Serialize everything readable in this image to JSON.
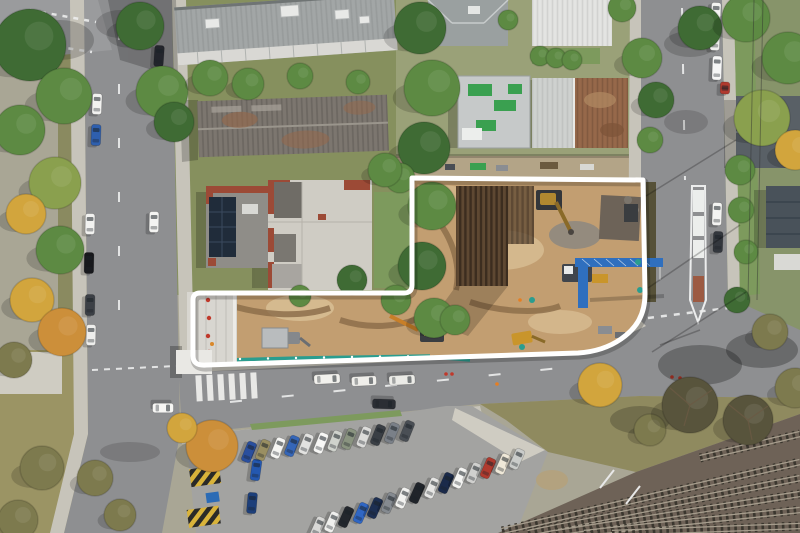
{
  "scene": {
    "type": "aerial-drone-photograph",
    "subject": "corner development site under excavation, outlined with a white property-boundary overlay",
    "no_visible_text": true
  },
  "palette": {
    "base": "#a9a695",
    "road": "#8e8f91",
    "roadLight": "#9a9b9d",
    "sidewalk": "#c7c4ba",
    "concretePad": "#cfccc2",
    "grass": "#76944f",
    "lawn": "#7d9a5d",
    "blockNW": "#86905e",
    "blockNE": "#9aa178",
    "blockE": "#87946a",
    "dirt": "#c29e71",
    "dirtLight": "#d7bc92",
    "dirtDark": "#8f6f4c",
    "piling": "#5e4832",
    "pilingDark": "#3c2d1f",
    "boundary": "#ffffff",
    "barrier": "#2a9d8f",
    "craneBlue": "#2f6fbe",
    "machineYellow": "#c9952b",
    "machineOrange": "#c87f28",
    "roofApartment": "#a2a6a6",
    "roofDark": "#7c766f",
    "rust": "#96684a",
    "roofWhite": "#e3e4e2",
    "roofFlat": "#cfccc4",
    "redTrim": "#9c4a36",
    "solar": "#202c3a",
    "shed": "#b9bcbe",
    "rail": "#6e6257",
    "railTie": "#3a362e",
    "railLine": "#a59c8c",
    "scrub": "#8f8a5f",
    "parking": "#a3a3a1",
    "hatchYellow": "#d9b33a",
    "g1": "#3f6b34",
    "g2": "#5d8a43",
    "g3": "#8aa04e",
    "y": "#d2a53d",
    "o": "#cc8f3a",
    "olv": "#7d7a4e",
    "bare": "#58543c"
  },
  "site_boundary": {
    "stroke_width": 5,
    "path": "M413,178 L643,180 L645,294 C645,314 637,328 621,339 C608,348 594,352 578,353 L206,365 Q193,366 193,356 L193,300 Q193,293 200,293 L404,293 Q412,293 412,285 L412,178 Z"
  },
  "trees": [
    [
      30,
      45,
      36,
      "g1"
    ],
    [
      64,
      96,
      28,
      "g2"
    ],
    [
      20,
      130,
      25,
      "g2"
    ],
    [
      55,
      183,
      26,
      "g3"
    ],
    [
      26,
      214,
      20,
      "y"
    ],
    [
      60,
      250,
      24,
      "g2"
    ],
    [
      32,
      300,
      22,
      "y"
    ],
    [
      62,
      332,
      24,
      "o"
    ],
    [
      14,
      360,
      18,
      "olv"
    ],
    [
      140,
      26,
      24,
      "g1"
    ],
    [
      162,
      92,
      26,
      "g2"
    ],
    [
      174,
      122,
      20,
      "g1"
    ],
    [
      210,
      78,
      18,
      "g2"
    ],
    [
      248,
      84,
      16,
      "g2"
    ],
    [
      300,
      76,
      13,
      "g2"
    ],
    [
      358,
      82,
      12,
      "g2"
    ],
    [
      420,
      28,
      26,
      "g1"
    ],
    [
      432,
      88,
      28,
      "g2"
    ],
    [
      424,
      148,
      26,
      "g1"
    ],
    [
      432,
      206,
      24,
      "g2"
    ],
    [
      422,
      266,
      24,
      "g1"
    ],
    [
      434,
      318,
      20,
      "g2"
    ],
    [
      400,
      178,
      15,
      "g2"
    ],
    [
      385,
      170,
      17,
      "g2"
    ],
    [
      352,
      280,
      15,
      "g1"
    ],
    [
      396,
      300,
      15,
      "g2"
    ],
    [
      300,
      296,
      11,
      "g2"
    ],
    [
      455,
      320,
      15,
      "g2"
    ],
    [
      540,
      56,
      10,
      "g2"
    ],
    [
      556,
      58,
      10,
      "g2"
    ],
    [
      572,
      60,
      10,
      "g2"
    ],
    [
      622,
      8,
      14,
      "g2"
    ],
    [
      642,
      58,
      20,
      "g2"
    ],
    [
      656,
      100,
      18,
      "g1"
    ],
    [
      650,
      140,
      13,
      "g2"
    ],
    [
      700,
      28,
      22,
      "g1"
    ],
    [
      746,
      18,
      24,
      "g2"
    ],
    [
      788,
      58,
      26,
      "g2"
    ],
    [
      762,
      118,
      28,
      "g3"
    ],
    [
      795,
      150,
      20,
      "y"
    ],
    [
      740,
      170,
      15,
      "g2"
    ],
    [
      741,
      210,
      13,
      "g2"
    ],
    [
      746,
      252,
      12,
      "g2"
    ],
    [
      737,
      300,
      13,
      "g1"
    ],
    [
      600,
      385,
      22,
      "y"
    ],
    [
      650,
      430,
      16,
      "olv"
    ],
    [
      770,
      332,
      18,
      "olv"
    ],
    [
      690,
      405,
      28,
      "bare"
    ],
    [
      748,
      420,
      25,
      "bare"
    ],
    [
      795,
      388,
      20,
      "olv"
    ],
    [
      212,
      446,
      26,
      "o"
    ],
    [
      182,
      428,
      15,
      "y"
    ],
    [
      95,
      478,
      18,
      "olv"
    ],
    [
      42,
      468,
      22,
      "olv"
    ],
    [
      18,
      520,
      20,
      "olv"
    ],
    [
      120,
      515,
      16,
      "olv"
    ],
    [
      508,
      20,
      10,
      "g2"
    ]
  ],
  "cars": [
    [
      97,
      104,
      2,
      "#f2f2f0"
    ],
    [
      96,
      135,
      2,
      "#2e5fae"
    ],
    [
      90,
      224,
      1,
      "#f2f2f0"
    ],
    [
      89,
      263,
      1,
      "#17181c"
    ],
    [
      90,
      305,
      1,
      "#3c4046"
    ],
    [
      91,
      335,
      1,
      "#eeeeec"
    ],
    [
      154,
      222,
      1,
      "#f4f4f2"
    ],
    [
      159,
      56,
      4,
      "#23252c"
    ],
    [
      157,
      79,
      4,
      "#b03a2e",
      10
    ],
    [
      163,
      408,
      90,
      "#f6f6f4"
    ],
    [
      327,
      379,
      87,
      "#f2f1ed",
      26
    ],
    [
      364,
      381,
      87,
      "#efeeea",
      25
    ],
    [
      402,
      380,
      87,
      "#ebebe7",
      26
    ],
    [
      384,
      404,
      92,
      "#2b2e34",
      23
    ],
    [
      716,
      13,
      2,
      "#f4f4f2"
    ],
    [
      715,
      40,
      2,
      "#eeeeec"
    ],
    [
      717,
      68,
      2,
      "#f6f6f6",
      24
    ],
    [
      725,
      88,
      2,
      "#b03a2e",
      12
    ],
    [
      717,
      214,
      2,
      "#f4f4f2",
      23
    ],
    [
      718,
      242,
      2,
      "#33373d"
    ],
    [
      256,
      470,
      8,
      "#2458b0"
    ],
    [
      252,
      503,
      5,
      "#1d3f7a"
    ]
  ],
  "parking": {
    "upper_row": {
      "rot": 22,
      "cars": [
        [
          249,
          452,
          "#2a4f9e"
        ],
        [
          263,
          450,
          "#9a8f62"
        ],
        [
          278,
          448,
          "#f5f5f3"
        ],
        [
          292,
          446,
          "#3566b8"
        ],
        [
          306,
          444,
          "#e2e2e0"
        ],
        [
          321,
          443,
          "#f7f7f5"
        ],
        [
          335,
          441,
          "#cfd2cc"
        ],
        [
          349,
          439,
          "#8a9480"
        ],
        [
          364,
          437,
          "#dcdcda"
        ],
        [
          378,
          435,
          "#3a3f45"
        ],
        [
          392,
          433,
          "#7a8088"
        ],
        [
          407,
          431,
          "#4a4f55"
        ]
      ]
    },
    "lower_row": {
      "rot": 24,
      "cars": [
        [
          318,
          527,
          "#d8d8d6"
        ],
        [
          332,
          522,
          "#efefed"
        ],
        [
          346,
          517,
          "#23272d"
        ],
        [
          361,
          513,
          "#2f66c4"
        ],
        [
          375,
          508,
          "#1d2f52"
        ],
        [
          389,
          503,
          "#858a90"
        ],
        [
          403,
          498,
          "#f2f2f0"
        ],
        [
          417,
          493,
          "#20242a"
        ],
        [
          432,
          488,
          "#e6e6e4"
        ],
        [
          446,
          483,
          "#1a2a4a"
        ],
        [
          460,
          478,
          "#f4f4f2"
        ],
        [
          474,
          473,
          "#d0d0ce"
        ],
        [
          488,
          468,
          "#b03a2e"
        ],
        [
          503,
          464,
          "#efe8d8"
        ],
        [
          517,
          459,
          "#caccca"
        ]
      ]
    }
  },
  "railway": {
    "tracks": [
      [
        502,
        531,
        800,
        462
      ],
      [
        528,
        533,
        800,
        478
      ],
      [
        556,
        533,
        800,
        494
      ],
      [
        584,
        533,
        800,
        510
      ],
      [
        612,
        533,
        800,
        526
      ],
      [
        700,
        458,
        800,
        434
      ]
    ]
  }
}
